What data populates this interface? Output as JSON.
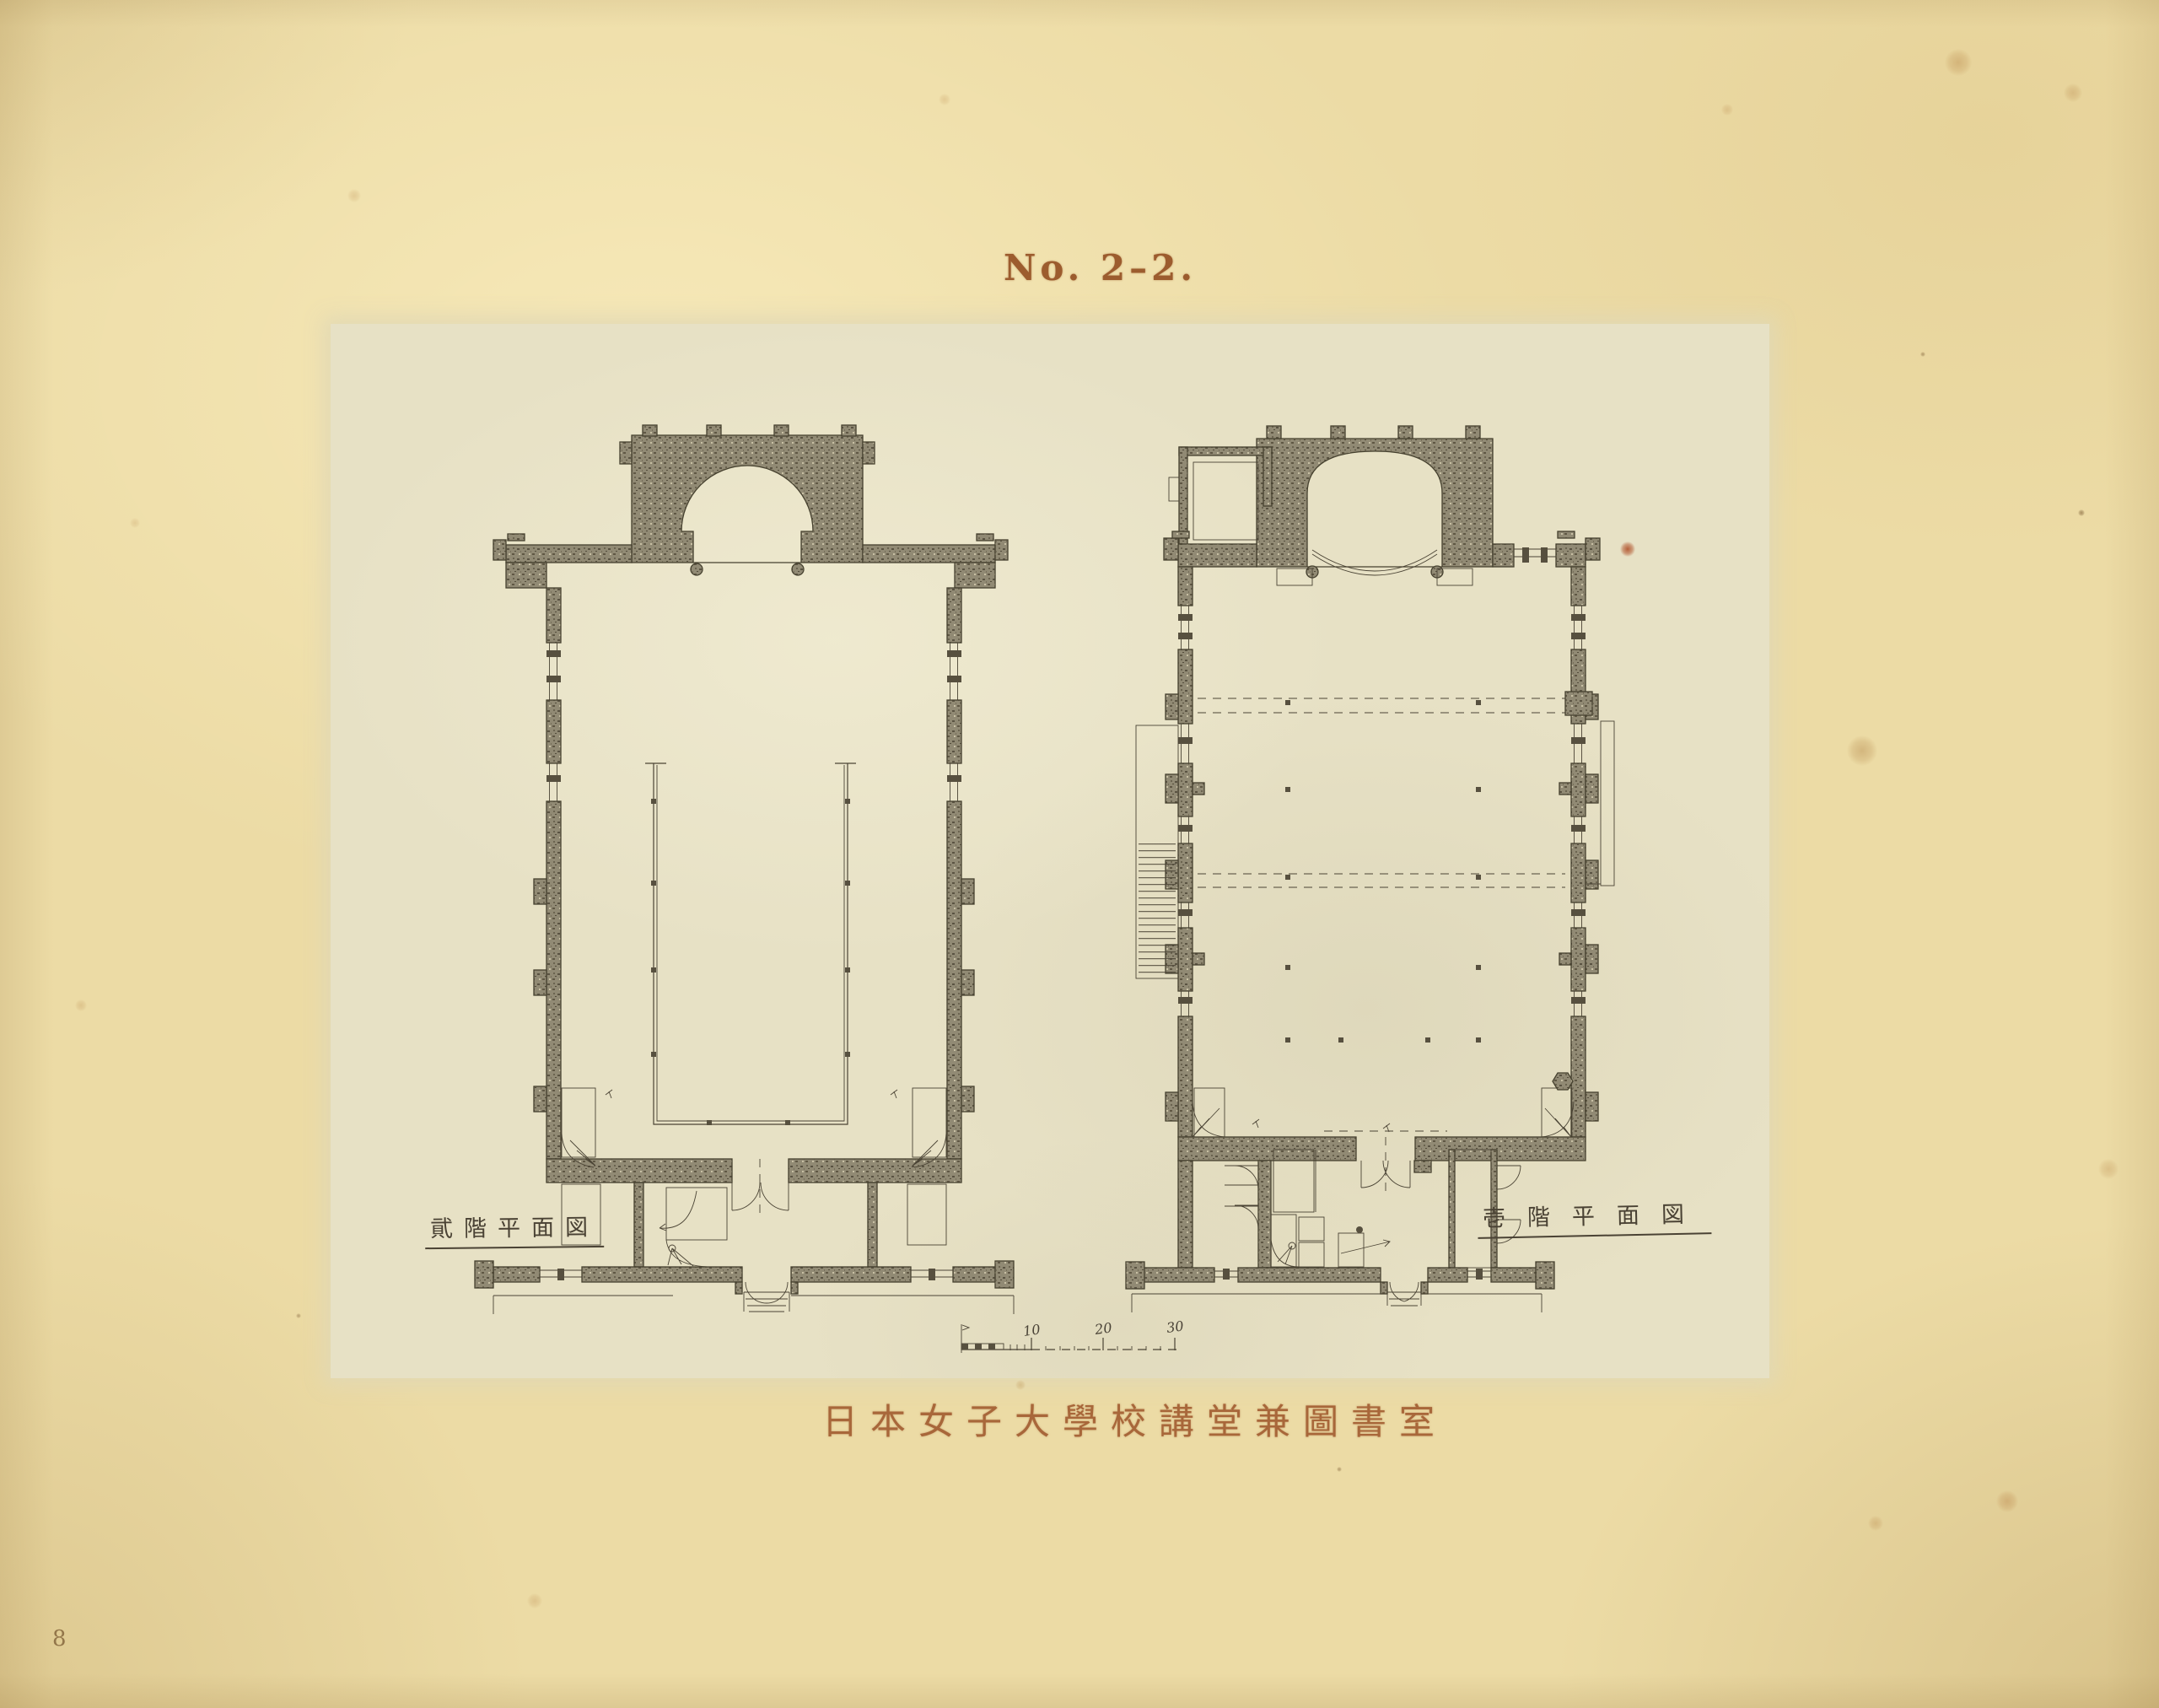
{
  "page": {
    "plate_number": "No. 2–2.",
    "page_number": "8",
    "caption": "日本女子大學校講堂兼圖書室"
  },
  "plans": {
    "left": {
      "label": "貮階平面図"
    },
    "right": {
      "label": "壱階平面図"
    }
  },
  "scale_bar": {
    "ticks": [
      "10",
      "20",
      "30"
    ]
  },
  "colors": {
    "paper": "#ecdba5",
    "plate": "#e7e1c5",
    "drawing_ink": "#4b4435",
    "wall_poche": "#918a74",
    "title_ink": "#9c5c2e",
    "caption_ink": "#a8673a",
    "label_ink": "#4a4234"
  }
}
